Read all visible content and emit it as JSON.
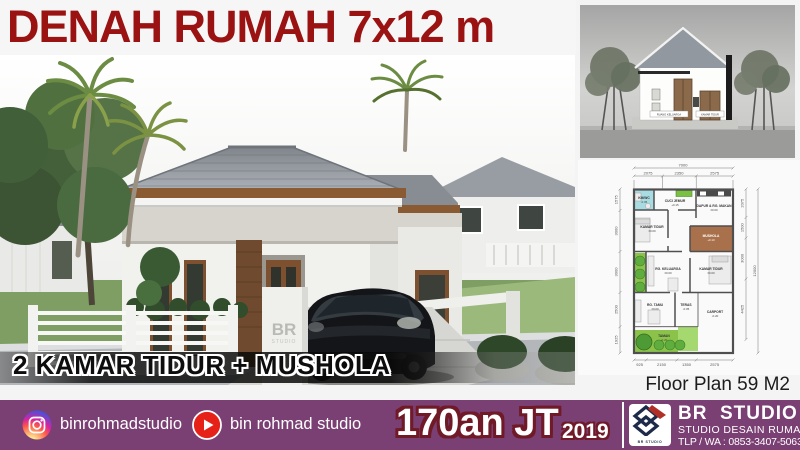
{
  "header": {
    "title": "DENAH RUMAH 7x12 m"
  },
  "render": {
    "caption": "2 KAMAR TIDUR + MUSHOLA",
    "watermark_line1": "BR",
    "watermark_line2": "STUDIO"
  },
  "section_panel": {
    "labels": [
      {
        "text": "RUANG KELUARGA"
      },
      {
        "text": "KAMAR TIDUR"
      }
    ]
  },
  "floor_plan": {
    "caption": "Floor Plan 59 M2",
    "overall_width": "7000",
    "overall_height": "12000",
    "top_dims": [
      "2075",
      "2350",
      "2575"
    ],
    "bottom_dims": [
      "925",
      "2150",
      "1350",
      "2575"
    ],
    "left_dims": [
      "1575",
      "3000",
      "3000",
      "2500",
      "1925"
    ],
    "right_dims": [
      "2075",
      "1500",
      "3000",
      "4425"
    ],
    "rooms": [
      {
        "name": "KM/WC",
        "level": "-0.05"
      },
      {
        "name": "CUCI JEMUR",
        "level": "+0.15"
      },
      {
        "name": "DAPUR & RG. MAKAN",
        "level": "±0.00"
      },
      {
        "name": "KAMAR TIDUR",
        "level": "±0.00"
      },
      {
        "name": "MUSHOLA",
        "level": "+0.10"
      },
      {
        "name": "RG. KELUARGA",
        "level": "±0.00"
      },
      {
        "name": "KAMAR TIDUR",
        "level": "±0.00"
      },
      {
        "name": "RG. TAMU",
        "level": "±0.00"
      },
      {
        "name": "TERAS",
        "level": "-0.05"
      },
      {
        "name": "CARPORT",
        "level": "-0.20"
      },
      {
        "name": "TAMAN",
        "level": "-0.20"
      }
    ]
  },
  "footer": {
    "instagram_handle": "binrohmadstudio",
    "youtube_handle": "bin rohmad studio",
    "price": "170an JT",
    "year": "2019",
    "logo_text": "BR STUDIO",
    "brand_name": "BR  STUDIO",
    "brand_subtitle": "STUDIO DESAIN RUMAH",
    "brand_contact": "TLP / WA : 0853-3407-5063"
  },
  "colors": {
    "title_red": "#9a1212",
    "footer_bar": "#7a3f73",
    "price_outline": "#701a28",
    "mushola_room": "#a9714b",
    "garden_green": "#8bc34a"
  }
}
